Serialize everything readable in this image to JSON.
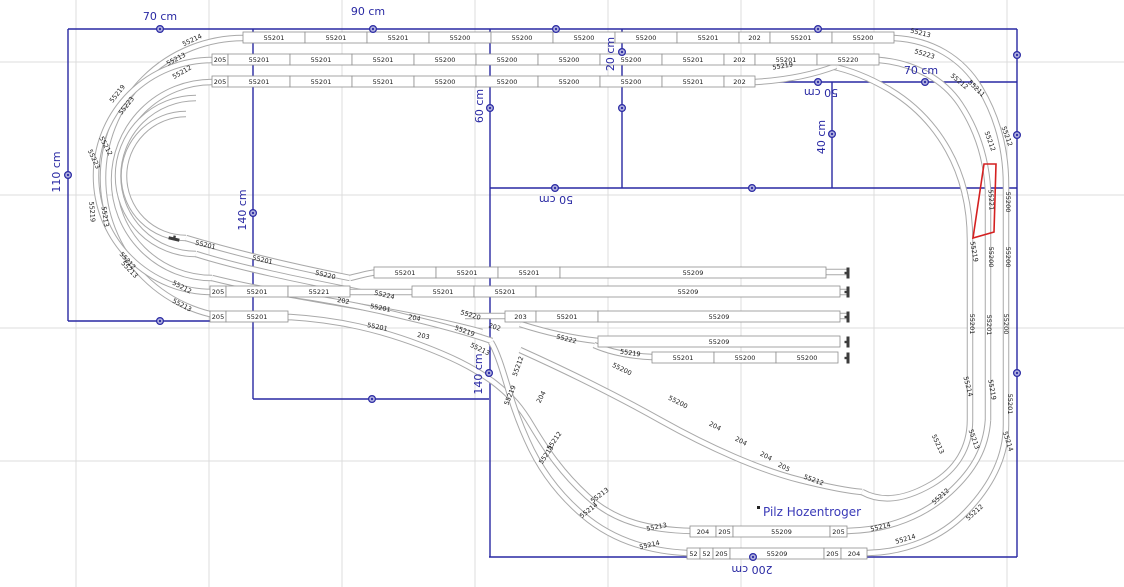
{
  "canvas": {
    "width": 1124,
    "height": 587,
    "background": "#ffffff",
    "grid": {
      "color": "#dcdcdc",
      "spacing": 133,
      "offset_x": 76,
      "offset_y": 62
    },
    "colors": {
      "dimension": "#2929a3",
      "handle_fill": "#aeaedd",
      "track": "#a9a9a9",
      "track_inner": "#ffffff",
      "box_border": "#8f8f8f",
      "label_text": "#1a1a1a",
      "selection": "#d42020",
      "annotation": "#3a3ab8",
      "bumper": "#3c3c3c"
    }
  },
  "construction": {
    "lines": [
      {
        "x1": 68,
        "y1": 29,
        "x2": 1017,
        "y2": 29
      },
      {
        "x1": 68,
        "y1": 29,
        "x2": 68,
        "y2": 321
      },
      {
        "x1": 68,
        "y1": 321,
        "x2": 253,
        "y2": 321
      },
      {
        "x1": 253,
        "y1": 29,
        "x2": 253,
        "y2": 399
      },
      {
        "x1": 253,
        "y1": 399,
        "x2": 489,
        "y2": 399
      },
      {
        "x1": 490,
        "y1": 29,
        "x2": 490,
        "y2": 557
      },
      {
        "x1": 490,
        "y1": 188,
        "x2": 1017,
        "y2": 188
      },
      {
        "x1": 622,
        "y1": 29,
        "x2": 622,
        "y2": 188
      },
      {
        "x1": 622,
        "y1": 82,
        "x2": 1017,
        "y2": 82
      },
      {
        "x1": 832,
        "y1": 82,
        "x2": 832,
        "y2": 188
      },
      {
        "x1": 1017,
        "y1": 29,
        "x2": 1017,
        "y2": 557
      },
      {
        "x1": 489,
        "y1": 557,
        "x2": 1017,
        "y2": 557
      }
    ],
    "handles": [
      {
        "x": 160,
        "y": 29
      },
      {
        "x": 373,
        "y": 29
      },
      {
        "x": 556,
        "y": 29
      },
      {
        "x": 818,
        "y": 29
      },
      {
        "x": 68,
        "y": 175
      },
      {
        "x": 160,
        "y": 321
      },
      {
        "x": 253,
        "y": 213
      },
      {
        "x": 372,
        "y": 399
      },
      {
        "x": 490,
        "y": 108
      },
      {
        "x": 622,
        "y": 52
      },
      {
        "x": 622,
        "y": 108
      },
      {
        "x": 555,
        "y": 188
      },
      {
        "x": 752,
        "y": 188
      },
      {
        "x": 818,
        "y": 82
      },
      {
        "x": 832,
        "y": 134
      },
      {
        "x": 925,
        "y": 82
      },
      {
        "x": 1017,
        "y": 55
      },
      {
        "x": 1017,
        "y": 135
      },
      {
        "x": 1017,
        "y": 373
      },
      {
        "x": 489,
        "y": 373
      },
      {
        "x": 753,
        "y": 557
      }
    ],
    "dimension_labels": [
      {
        "text": "70 cm",
        "x": 160,
        "y": 20,
        "rot": 0
      },
      {
        "text": "90 cm",
        "x": 368,
        "y": 15,
        "rot": 0
      },
      {
        "text": "110 cm",
        "x": 60,
        "y": 172,
        "rot": -90
      },
      {
        "text": "140 cm",
        "x": 246,
        "y": 210,
        "rot": -90
      },
      {
        "text": "60 cm",
        "x": 483,
        "y": 106,
        "rot": -90
      },
      {
        "text": "20 cm",
        "x": 614,
        "y": 54,
        "rot": -90
      },
      {
        "text": "50 cm",
        "x": 556,
        "y": 196,
        "rot": 180
      },
      {
        "text": "50 cm",
        "x": 821,
        "y": 89,
        "rot": 180
      },
      {
        "text": "40 cm",
        "x": 825,
        "y": 137,
        "rot": -90
      },
      {
        "text": "70 cm",
        "x": 921,
        "y": 74,
        "rot": 0
      },
      {
        "text": "140 cm",
        "x": 482,
        "y": 374,
        "rot": -90
      },
      {
        "text": "200 cm",
        "x": 752,
        "y": 566,
        "rot": 180
      }
    ]
  },
  "geometry": {
    "track_paths": [
      "M894,38 L243,38",
      "M879,60 L212,60",
      "M755,82 L212,82",
      "M243,38 A140,140 0 0 0 243,318",
      "M212,60 A116,116 0 0 0 212,292",
      "M212,82 A98,98 0 0 0 212,278",
      "M196,98 A76,76 0 0 0 196,254",
      "M186,114 A62,62 0 0 0 186,238",
      "M212,278 C260,290 320,300 380,310 C420,317 452,324 482,332",
      "M196,254 C240,268 300,280 360,292",
      "M186,238 C232,252 290,266 350,278",
      "M350,278 C362,275 372,272 382,272 L848,272",
      "M212,292 L848,292",
      "M243,318 L290,317 C340,320 380,330 420,345 C452,357 472,367 492,381 C512,396 522,409 532,426 C547,451 562,473 587,496 C616,523 652,530 692,531",
      "M288,294 C330,300 370,308 410,318 C440,325 466,332 492,341",
      "M465,316 L848,316",
      "M598,341 C570,338 545,332 520,324",
      "M652,357 C628,356 610,352 594,345",
      "M520,350 C560,368 610,392 660,420 C710,448 760,470 800,480 C832,488 850,491 862,492",
      "M692,531 L847,531",
      "M687,553 L868,553",
      "M687,553 C645,551 610,538 583,515 C556,492 538,465 527,440 C518,420 512,402 508,388 C502,368 497,352 491,342",
      "M847,531 C890,530 925,515 950,492 C974,470 986,448 988,420",
      "M868,553 C906,552 941,538 966,512 C993,484 1006,455 1006,425",
      "M894,38 C932,40 962,58 980,88 C998,118 1006,150 1006,185 L1006,425",
      "M879,60 C915,63 944,80 960,104 C976,128 986,156 988,190 L988,420",
      "M830,66 C850,70 870,78 890,90 C915,105 934,125 948,150 C962,175 970,205 970,240 L970,420",
      "M755,82 C790,80 815,74 836,66",
      "M970,420 C970,448 956,470 932,484 C908,498 884,504 862,492"
    ],
    "selection_path": "M984,164 L996,164 L994,232 L973,238 Z",
    "annotation_marker": {
      "x": 757,
      "y": 506
    }
  },
  "box_rows": [
    {
      "x": 243,
      "y": 32,
      "cells": [
        {
          "t": "55201",
          "w": 62
        },
        {
          "t": "55201",
          "w": 62
        },
        {
          "t": "55201",
          "w": 62
        },
        {
          "t": "55200",
          "w": 62
        },
        {
          "t": "55200",
          "w": 62
        },
        {
          "t": "55200",
          "w": 62
        },
        {
          "t": "55200",
          "w": 62
        },
        {
          "t": "55201",
          "w": 62
        },
        {
          "t": "202",
          "w": 31
        },
        {
          "t": "55201",
          "w": 62
        },
        {
          "t": "55200",
          "w": 62
        }
      ]
    },
    {
      "x": 212,
      "y": 54,
      "cells": [
        {
          "t": "205",
          "w": 16
        },
        {
          "t": "55201",
          "w": 62
        },
        {
          "t": "55201",
          "w": 62
        },
        {
          "t": "55201",
          "w": 62
        },
        {
          "t": "55200",
          "w": 62
        },
        {
          "t": "55200",
          "w": 62
        },
        {
          "t": "55200",
          "w": 62
        },
        {
          "t": "55200",
          "w": 62
        },
        {
          "t": "55201",
          "w": 62
        },
        {
          "t": "202",
          "w": 31
        },
        {
          "t": "55201",
          "w": 62
        },
        {
          "t": "55220",
          "w": 62
        }
      ]
    },
    {
      "x": 212,
      "y": 76,
      "cells": [
        {
          "t": "205",
          "w": 16
        },
        {
          "t": "55201",
          "w": 62
        },
        {
          "t": "55201",
          "w": 62
        },
        {
          "t": "55201",
          "w": 62
        },
        {
          "t": "55200",
          "w": 62
        },
        {
          "t": "55200",
          "w": 62
        },
        {
          "t": "55200",
          "w": 62
        },
        {
          "t": "55200",
          "w": 62
        },
        {
          "t": "55201",
          "w": 62
        },
        {
          "t": "202",
          "w": 31
        }
      ]
    },
    {
      "x": 374,
      "y": 267,
      "cells": [
        {
          "t": "55201",
          "w": 62
        },
        {
          "t": "55201",
          "w": 62
        },
        {
          "t": "55201",
          "w": 62
        },
        {
          "t": "55209",
          "w": 266
        }
      ]
    },
    {
      "x": 210,
      "y": 286,
      "cells": [
        {
          "t": "205",
          "w": 16
        },
        {
          "t": "55201",
          "w": 62
        },
        {
          "t": "55221",
          "w": 62
        }
      ]
    },
    {
      "x": 412,
      "y": 286,
      "cells": [
        {
          "t": "55201",
          "w": 62
        },
        {
          "t": "55201",
          "w": 62
        }
      ]
    },
    {
      "x": 536,
      "y": 286,
      "cells": [
        {
          "t": "55209",
          "w": 304
        }
      ]
    },
    {
      "x": 210,
      "y": 311,
      "cells": [
        {
          "t": "205",
          "w": 16
        },
        {
          "t": "55201",
          "w": 62
        }
      ]
    },
    {
      "x": 505,
      "y": 311,
      "cells": [
        {
          "t": "203",
          "w": 31
        },
        {
          "t": "55201",
          "w": 62
        },
        {
          "t": "55209",
          "w": 242
        }
      ]
    },
    {
      "x": 598,
      "y": 336,
      "cells": [
        {
          "t": "55209",
          "w": 242
        }
      ]
    },
    {
      "x": 652,
      "y": 352,
      "cells": [
        {
          "t": "55201",
          "w": 62
        },
        {
          "t": "55200",
          "w": 62
        },
        {
          "t": "55200",
          "w": 62
        }
      ]
    },
    {
      "x": 690,
      "y": 526,
      "cells": [
        {
          "t": "204",
          "w": 26
        },
        {
          "t": "205",
          "w": 17
        },
        {
          "t": "55209",
          "w": 97
        },
        {
          "t": "205",
          "w": 17
        }
      ]
    },
    {
      "x": 687,
      "y": 548,
      "cells": [
        {
          "t": "52",
          "w": 13
        },
        {
          "t": "52",
          "w": 13
        },
        {
          "t": "205",
          "w": 17
        },
        {
          "t": "55209",
          "w": 94
        },
        {
          "t": "205",
          "w": 17
        },
        {
          "t": "204",
          "w": 26
        }
      ]
    }
  ],
  "free_labels": [
    {
      "t": "55214",
      "x": 193,
      "y": 42,
      "r": -25
    },
    {
      "t": "55213",
      "x": 177,
      "y": 61,
      "r": -28
    },
    {
      "t": "55212",
      "x": 183,
      "y": 74,
      "r": -30
    },
    {
      "t": "55219",
      "x": 119,
      "y": 95,
      "r": -52
    },
    {
      "t": "55223",
      "x": 128,
      "y": 107,
      "r": -52
    },
    {
      "t": "55212",
      "x": 104,
      "y": 147,
      "r": 62
    },
    {
      "t": "55223",
      "x": 92,
      "y": 160,
      "r": 65
    },
    {
      "t": "55219",
      "x": 90,
      "y": 212,
      "r": 85
    },
    {
      "t": "55213",
      "x": 103,
      "y": 217,
      "r": 82
    },
    {
      "t": "55212",
      "x": 126,
      "y": 262,
      "r": 48
    },
    {
      "t": "55213",
      "x": 128,
      "y": 271,
      "r": 46
    },
    {
      "t": "55212",
      "x": 181,
      "y": 289,
      "r": 28
    },
    {
      "t": "55213",
      "x": 181,
      "y": 307,
      "r": 28
    },
    {
      "t": "55201",
      "x": 205,
      "y": 247,
      "r": 13
    },
    {
      "t": "55201",
      "x": 262,
      "y": 262,
      "r": 13
    },
    {
      "t": "55220",
      "x": 325,
      "y": 277,
      "r": 13
    },
    {
      "t": "55224",
      "x": 384,
      "y": 297,
      "r": 13
    },
    {
      "t": "202",
      "x": 343,
      "y": 303,
      "r": 10
    },
    {
      "t": "55201",
      "x": 380,
      "y": 310,
      "r": 11
    },
    {
      "t": "204",
      "x": 414,
      "y": 320,
      "r": 12
    },
    {
      "t": "55201",
      "x": 377,
      "y": 329,
      "r": 11
    },
    {
      "t": "203",
      "x": 423,
      "y": 338,
      "r": 12
    },
    {
      "t": "202",
      "x": 494,
      "y": 329,
      "r": 18
    },
    {
      "t": "55220",
      "x": 470,
      "y": 317,
      "r": 16
    },
    {
      "t": "55219",
      "x": 464,
      "y": 333,
      "r": 20
    },
    {
      "t": "55213",
      "x": 479,
      "y": 351,
      "r": 26
    },
    {
      "t": "55222",
      "x": 566,
      "y": 341,
      "r": 14
    },
    {
      "t": "55219",
      "x": 630,
      "y": 355,
      "r": 8
    },
    {
      "t": "55219",
      "x": 783,
      "y": 68,
      "r": -9
    },
    {
      "t": "55200",
      "x": 621,
      "y": 371,
      "r": 26
    },
    {
      "t": "55200",
      "x": 677,
      "y": 404,
      "r": 27
    },
    {
      "t": "204",
      "x": 714,
      "y": 428,
      "r": 28
    },
    {
      "t": "204",
      "x": 740,
      "y": 443,
      "r": 28
    },
    {
      "t": "204",
      "x": 765,
      "y": 458,
      "r": 28
    },
    {
      "t": "205",
      "x": 783,
      "y": 469,
      "r": 28
    },
    {
      "t": "55212",
      "x": 813,
      "y": 482,
      "r": 20
    },
    {
      "t": "55212",
      "x": 520,
      "y": 367,
      "r": -70
    },
    {
      "t": "55219",
      "x": 512,
      "y": 396,
      "r": -68
    },
    {
      "t": "204",
      "x": 543,
      "y": 398,
      "r": -62
    },
    {
      "t": "55212",
      "x": 556,
      "y": 442,
      "r": -55
    },
    {
      "t": "55213",
      "x": 548,
      "y": 456,
      "r": -55
    },
    {
      "t": "55213",
      "x": 601,
      "y": 497,
      "r": -37
    },
    {
      "t": "55214",
      "x": 590,
      "y": 512,
      "r": -38
    },
    {
      "t": "55213",
      "x": 657,
      "y": 529,
      "r": -12
    },
    {
      "t": "55214",
      "x": 650,
      "y": 547,
      "r": -13
    },
    {
      "t": "55214",
      "x": 881,
      "y": 529,
      "r": -14
    },
    {
      "t": "55214",
      "x": 906,
      "y": 541,
      "r": -16
    },
    {
      "t": "55212",
      "x": 942,
      "y": 498,
      "r": -42
    },
    {
      "t": "55212",
      "x": 976,
      "y": 514,
      "r": -42
    },
    {
      "t": "55213",
      "x": 936,
      "y": 445,
      "r": 65
    },
    {
      "t": "55213",
      "x": 972,
      "y": 440,
      "r": 70
    },
    {
      "t": "55214",
      "x": 1006,
      "y": 442,
      "r": 72
    },
    {
      "t": "55213",
      "x": 920,
      "y": 35,
      "r": 14
    },
    {
      "t": "55223",
      "x": 924,
      "y": 56,
      "r": 16
    },
    {
      "t": "55212",
      "x": 958,
      "y": 83,
      "r": 40
    },
    {
      "t": "55211",
      "x": 975,
      "y": 90,
      "r": 45
    },
    {
      "t": "55212",
      "x": 988,
      "y": 142,
      "r": 70
    },
    {
      "t": "55212",
      "x": 1005,
      "y": 137,
      "r": 70
    },
    {
      "t": "55200",
      "x": 1006,
      "y": 202,
      "r": 90
    },
    {
      "t": "55219",
      "x": 972,
      "y": 252,
      "r": 80
    },
    {
      "t": "55200",
      "x": 989,
      "y": 257,
      "r": 90
    },
    {
      "t": "55200",
      "x": 1006,
      "y": 257,
      "r": 90
    },
    {
      "t": "55201",
      "x": 970,
      "y": 324,
      "r": 90
    },
    {
      "t": "55201",
      "x": 987,
      "y": 325,
      "r": 90
    },
    {
      "t": "55200",
      "x": 1004,
      "y": 324,
      "r": 90
    },
    {
      "t": "55214",
      "x": 966,
      "y": 387,
      "r": 75
    },
    {
      "t": "55219",
      "x": 990,
      "y": 390,
      "r": 80
    },
    {
      "t": "55201",
      "x": 1008,
      "y": 404,
      "r": 90
    }
  ],
  "bumpers": [
    {
      "x": 848,
      "y": 273,
      "r": 0
    },
    {
      "x": 848,
      "y": 292,
      "r": 0
    },
    {
      "x": 848,
      "y": 317,
      "r": 0
    },
    {
      "x": 848,
      "y": 342,
      "r": 0
    },
    {
      "x": 848,
      "y": 358,
      "r": 0
    },
    {
      "x": 174,
      "y": 239,
      "r": 103
    }
  ],
  "selection": {
    "label": {
      "t": "55221",
      "x": 989,
      "y": 200,
      "r": 87
    }
  },
  "annotation": {
    "text": "Pilz Hozentroger",
    "x": 763,
    "y": 515
  }
}
